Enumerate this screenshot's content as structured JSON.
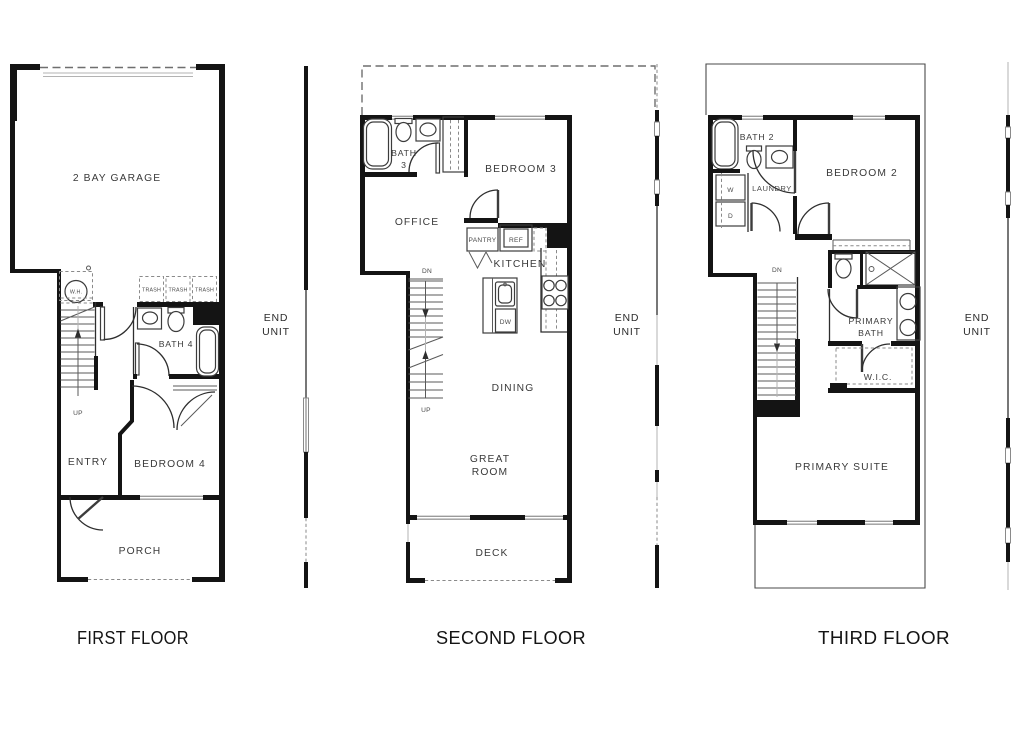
{
  "floors": [
    {
      "caption": "FIRST FLOOR",
      "labels": {
        "garage": "2 BAY GARAGE",
        "bath": "BATH 4",
        "entry": "ENTRY",
        "bedroom": "BEDROOM 4",
        "porch": "PORCH",
        "water_heater": "W.H.",
        "trash": "TRASH",
        "up": "UP"
      }
    },
    {
      "caption": "SECOND FLOOR",
      "labels": {
        "bath_line1": "BATH",
        "bath_line2": "3",
        "bedroom": "BEDROOM 3",
        "office": "OFFICE",
        "kitchen": "KITCHEN",
        "dining": "DINING",
        "great_line1": "GREAT",
        "great_line2": "ROOM",
        "deck": "DECK",
        "pantry": "PANTRY",
        "fridge": "REF",
        "dishwasher": "DW",
        "up": "UP",
        "down": "DN"
      }
    },
    {
      "caption": "THIRD FLOOR",
      "labels": {
        "bath": "BATH 2",
        "bedroom": "BEDROOM 2",
        "laundry": "LAUNDRY",
        "washer": "W",
        "dryer": "D",
        "primary_bath_line1": "PRIMARY",
        "primary_bath_line2": "BATH",
        "wic": "W.I.C.",
        "suite": "PRIMARY SUITE",
        "down": "DN"
      }
    }
  ],
  "annotations": {
    "end_unit_line1": "END",
    "end_unit_line2": "UNIT"
  },
  "colors": {
    "wall": "#141414",
    "window_gray": "#9a9a9a",
    "background": "#ffffff"
  }
}
